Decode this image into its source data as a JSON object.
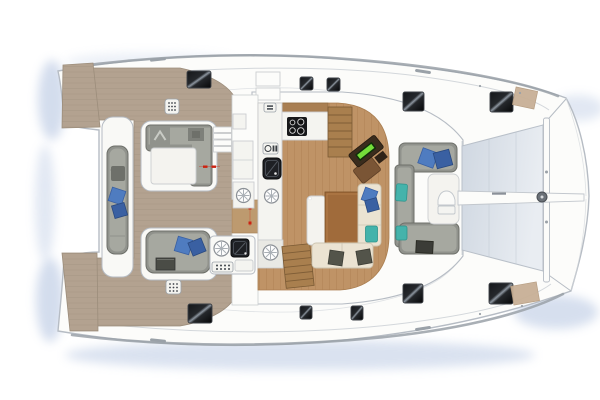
{
  "diagram": {
    "kind": "catamaran-deck-plan",
    "view": "overhead",
    "visible_text": []
  },
  "colors": {
    "hull_stroke": "#b6bcc4",
    "deck_white": "#fcfcfa",
    "island_white": "#f9f9f6",
    "seam": "#d3d7db",
    "toerail": "#9aa1a8",
    "water": "#9fb4d8",
    "teak": "#b3a290",
    "teak_line": "#9c8d7b",
    "salon_floor": "#bf9366",
    "salon_floor_line": "#aa7e50",
    "counter": "#f4f4f0",
    "counter_stroke": "#cbced0",
    "appliance_dark": "#1e2024",
    "sofa_gray": "#90928c",
    "sofa_gray_dark": "#6e706a",
    "sofa_gray_light": "#a6a8a0",
    "cushion_white": "#f4f3ef",
    "pillow_blue": "#4f7cc0",
    "pillow_blue_dark": "#3a60a2",
    "pillow_teal": "#44b3ab",
    "bench_cream": "#ebe3d2",
    "bench_cream_stroke": "#cdc5b2",
    "pillow_olive": "#53544a",
    "table_wood": "#a06b3b",
    "stair_wood": "#a97f4e",
    "stair_line": "#7a5a34",
    "desk_dark": "#3a2c1d",
    "desk_seat": "#7a5535",
    "screen_green": "#74dd3a",
    "tramp_light": "#e9edf2",
    "tramp_dark": "#cfd7e1",
    "hatch_shine": "#8d96a0",
    "marker_red": "#cc2211",
    "bow_pad_tan": "#c8b096",
    "metal_gray": "#6b7178"
  },
  "features": [
    "hull-silhouette",
    "bow-trampoline",
    "bow-crossbeam",
    "bowsprit",
    "aft-teak-deck",
    "transom-platform-top",
    "transom-platform-bottom",
    "aft-bench",
    "aft-lounge-upper",
    "aft-lounge-lower",
    "outdoor-galley",
    "salon",
    "galley-counter",
    "cooktop",
    "galley-sink",
    "oven-icon",
    "round-sink-icon",
    "hull-stairs-top",
    "hull-stairs-bottom",
    "nav-station",
    "chartplotter-screen",
    "dinette-table",
    "dinette-bench",
    "forward-cockpit",
    "forward-sofa",
    "forward-seat-table",
    "deck-hatch",
    "vent-grid",
    "bow-antislip-pad",
    "door-marker"
  ]
}
